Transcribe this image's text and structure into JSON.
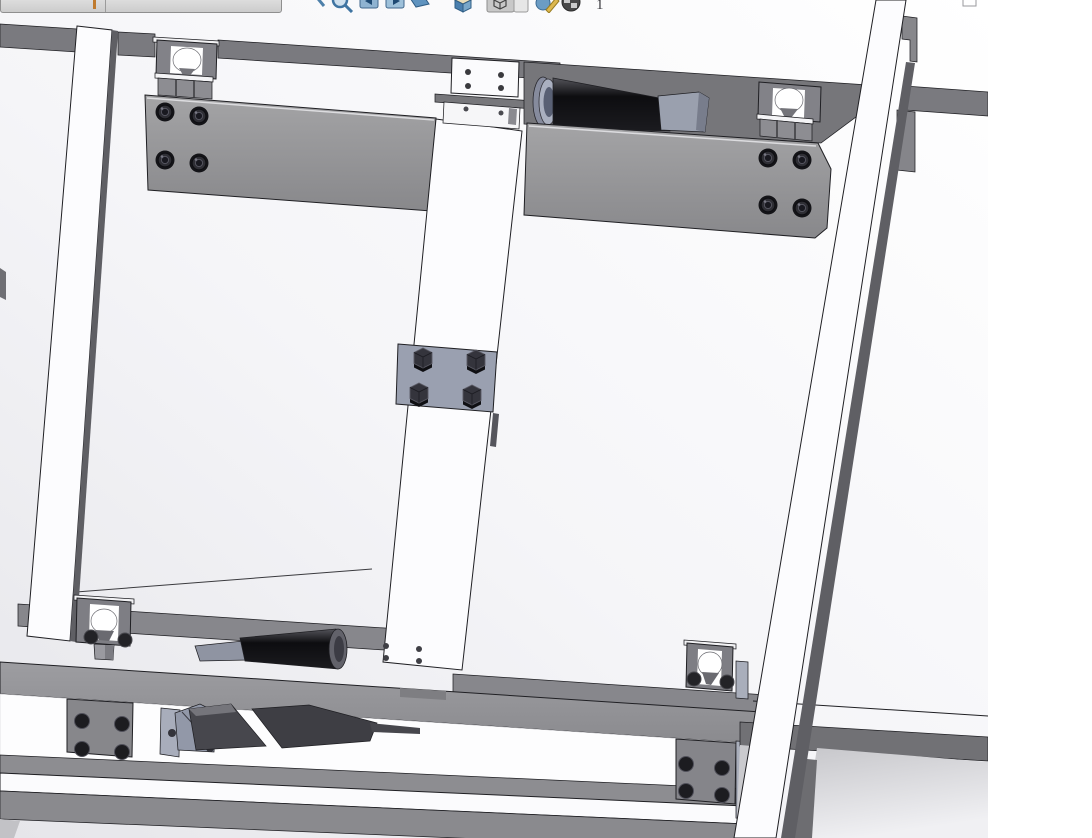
{
  "toolbar": {
    "page_label": "1",
    "icons": [
      {
        "name": "zoom-in-icon"
      },
      {
        "name": "zoom-to-area-icon"
      },
      {
        "name": "previous-view-icon"
      },
      {
        "name": "next-view-icon"
      },
      {
        "name": "section-view-icon"
      },
      {
        "name": "view-orientation-icon"
      },
      {
        "name": "display-style-icon"
      },
      {
        "name": "edit-appearance-icon"
      },
      {
        "name": "apply-scene-icon"
      }
    ]
  },
  "mini_bar": {
    "has_divider": true,
    "accent_tick_color": "#bf7a2e"
  },
  "viewport": {
    "background_top": "#ffffff",
    "background_bottom": "#e6e6ea",
    "edge_color": "#1f1f23"
  },
  "palette": {
    "frame_gray": "#97979b",
    "dark_gray": "#7a7a7f",
    "plate_gray": "#8f8f93",
    "lavender_gray": "#a6abb9",
    "roller_black": "#0b0b0d",
    "white_part": "#fcfcfe"
  }
}
